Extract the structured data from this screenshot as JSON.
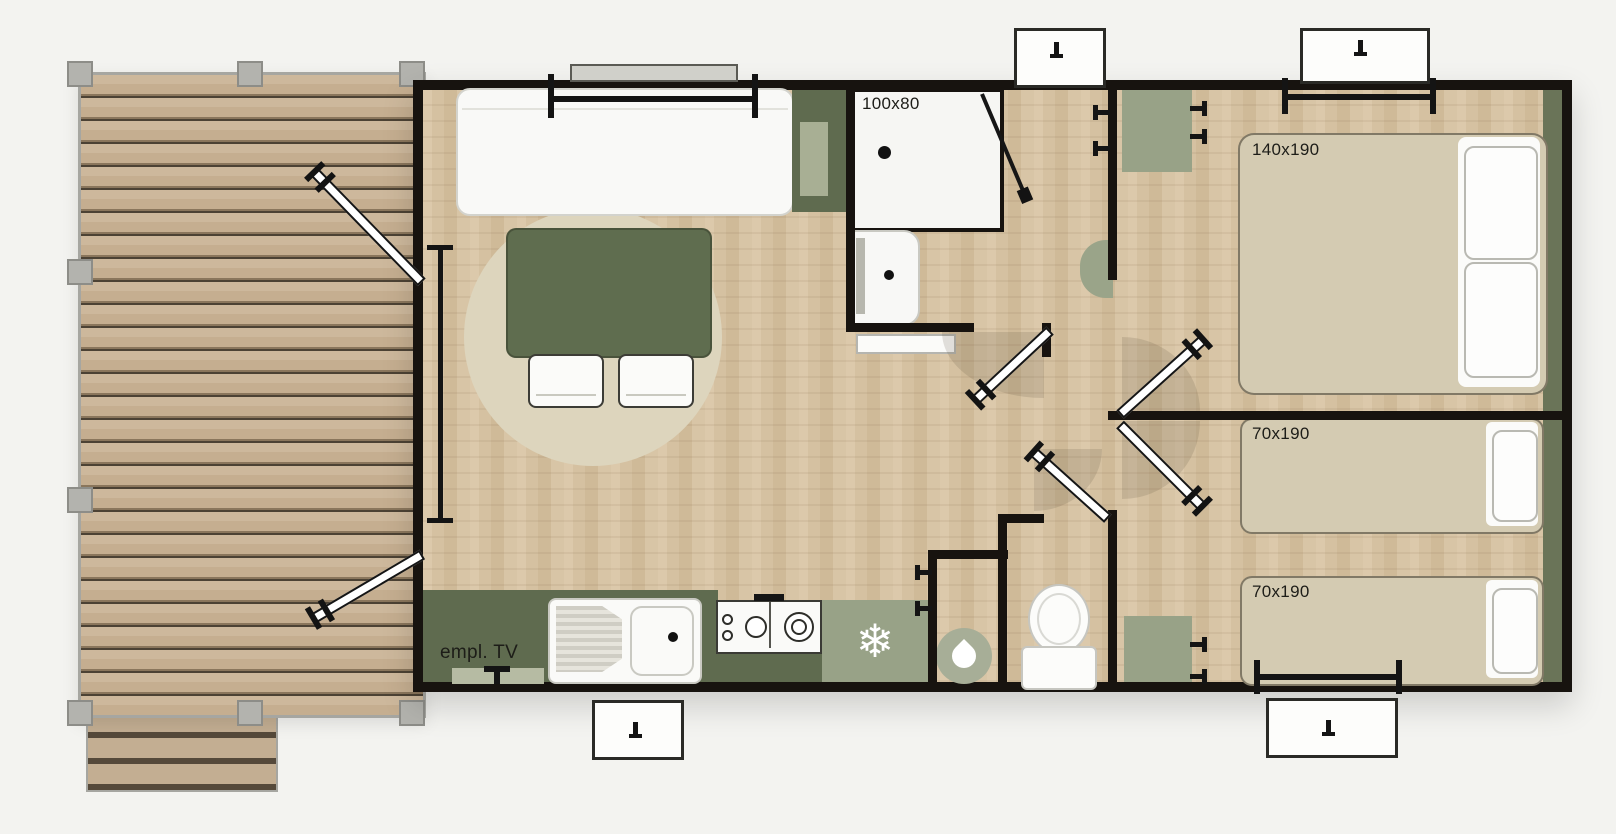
{
  "plan": {
    "shower_label": "100x80",
    "double_bed_label": "140x190",
    "single_bed_1_label": "70x190",
    "single_bed_2_label": "70x190",
    "tv_label": "empl. TV",
    "snowflake_icon": "❄"
  },
  "palette": {
    "background": "#f3f3f0",
    "wall": "#17130f",
    "deck_wood": "#c5ae90",
    "floor_wood": "#d5c1a1",
    "dark_sage": "#5f6b4f",
    "light_sage": "#98a287",
    "bed_beige": "#d4cbb2",
    "fixture_white": "#fafaf8"
  }
}
